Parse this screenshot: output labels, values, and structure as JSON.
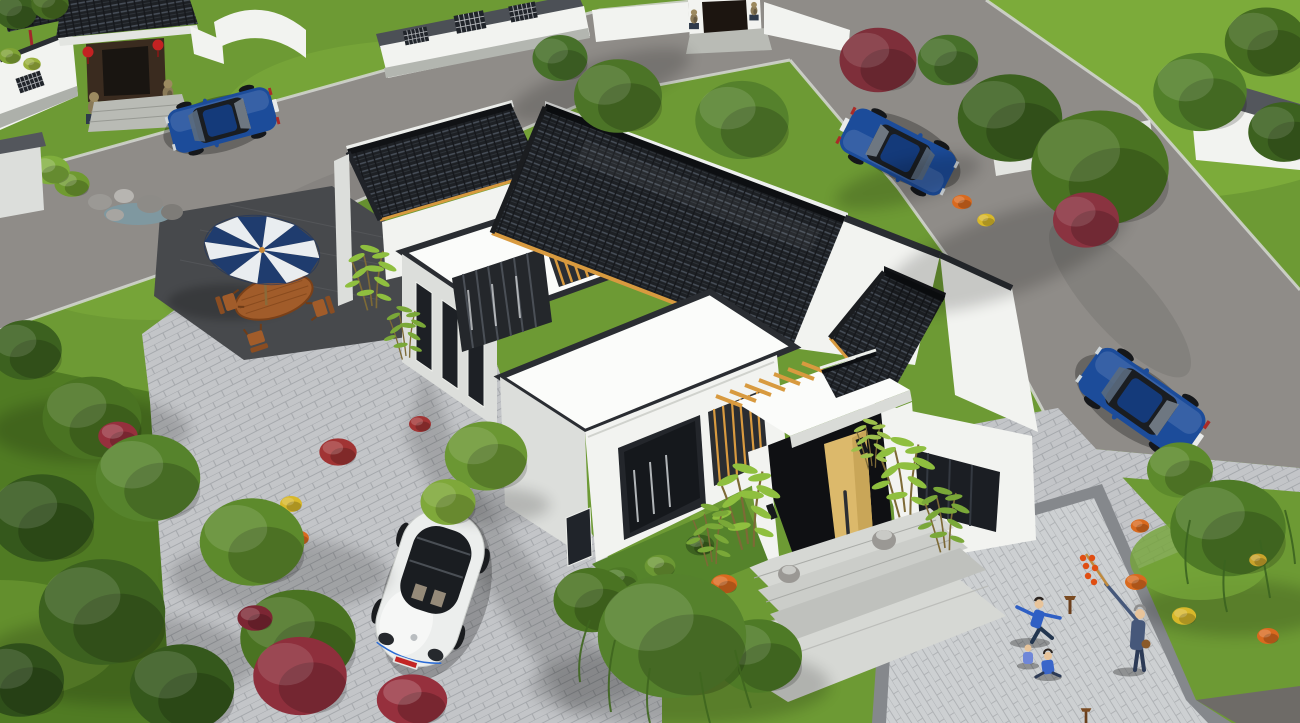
{
  "image": {
    "type": "3d architectural rendering",
    "view": "aerial isometric bird's-eye view",
    "subject": "Modern Chinese-style single-storey courtyard house with white stucco walls and dark grey clay-tile roofs",
    "setting": "Landscaped residential compound with lawns, trees, paver driveways, roads and neighbouring traditional houses"
  },
  "palette": {
    "grass": "#6d9a34",
    "grass-light": "#7fae3c",
    "grass-dark": "#49731f",
    "road": "#8f8c88",
    "road-dark": "#6e6b67",
    "paver": "#c3c5c8",
    "paver-line": "#a6a9ad",
    "paver-warm": "#cdd0d2",
    "paver-warm-line": "#b0b3b6",
    "patio": "#47494c",
    "granite": "#d6d8d4",
    "wall": "#f2f3f0",
    "wall-shade": "#dcdedb",
    "roof-white": "#fbfcfa",
    "trim": "#2a2d32",
    "tile": "#1d2024",
    "tile-line": "#454c56",
    "wood": "#d89a3f",
    "door": "#dcb96b",
    "umbrella-navy": "#1f3c6e",
    "umbrella-white": "#e9edf0",
    "furniture": "#a15c2a",
    "car-blue": "#1c4c9a",
    "car-blue-dark": "#143a7a",
    "car-white": "#eceeed",
    "glass": "#1a1d21",
    "bush-red": "#96303d",
    "flower-orange": "#d96a1f",
    "flower-yellow": "#d8b82a",
    "lantern": "#c32222",
    "stone": "#9a9894",
    "water": "#7f98a0",
    "skin": "#e8c49a",
    "blue-clothes": "#2f5fc4",
    "navy-clothes": "#46587a",
    "tree-dark": "#3c611f",
    "tree-mid": "#4e7a26",
    "tree-light": "#6b9733",
    "bamboo-green": "#8fbf3f"
  },
  "scene": {
    "groups": {
      "ground": "lawns and ground plane",
      "roads": "grey asphalt roads with concrete curbs",
      "pavers": "grey brick paver driveway, plazas and granite entry walkway",
      "neighborhood": "neighbouring traditional gatehouse with red lanterns, stone lions and white lattice walls",
      "main_house": "Chinese-style courtyard house: white walls, dark tiled roofs, flat roof terraces, timber pergolas, louvered windows, wooden entry door ajar, stone drum pedestals, granite steps",
      "patio": "patio with navy-and-white striped umbrella, oval wooden table and four wooden chairs",
      "rock_garden": "rock garden with small pond",
      "vehicles": "one white VW Beetle and three blue sedans",
      "vegetation": "deciduous trees, weeping willows, crimson shrubs, bamboo clumps, orange and yellow flower bushes",
      "people": "residents exercising and children playing on the plaza"
    },
    "main_house": {
      "label": "main courtyard house",
      "walls": "white stucco",
      "roof": "dark grey clay tiles with black ridge caps and timber eave strips",
      "features": [
        "flat roof terraces with dark parapets",
        "inner court timber pergola slats",
        "curtained windows with wooden louver screens",
        "light wooden entry door ajar",
        "white entry canopy",
        "stone drum pedestals",
        "granite steps",
        "bamboo planting"
      ]
    },
    "vehicles": [
      {
        "label": "white VW Beetle parked on paver driveway",
        "color": "white",
        "plate": "red"
      },
      {
        "label": "blue sedan at neighbour gatehouse (top left)",
        "color": "blue"
      },
      {
        "label": "blue sedan on upper road (top right)",
        "color": "blue"
      },
      {
        "label": "blue sedan parked on east road (rear view)",
        "color": "blue",
        "plate": "white"
      }
    ],
    "people": [
      {
        "label": "woman in blue exercising (tai chi) on plaza"
      },
      {
        "label": "child sitting on plaza"
      },
      {
        "label": "second child sitting on plaza"
      },
      {
        "label": "elder in navy holding candied-hawthorn stick"
      }
    ],
    "amenities": {
      "umbrella": "navy and white striped patio umbrella",
      "table": "oval wooden dining table",
      "chairs": 4
    },
    "landscape": [
      "lawns",
      "deciduous trees",
      "crimson shrubs",
      "orange flower bushes",
      "yellow flower bushes",
      "rock garden with pond",
      "weeping willows",
      "bamboo clumps"
    ]
  }
}
